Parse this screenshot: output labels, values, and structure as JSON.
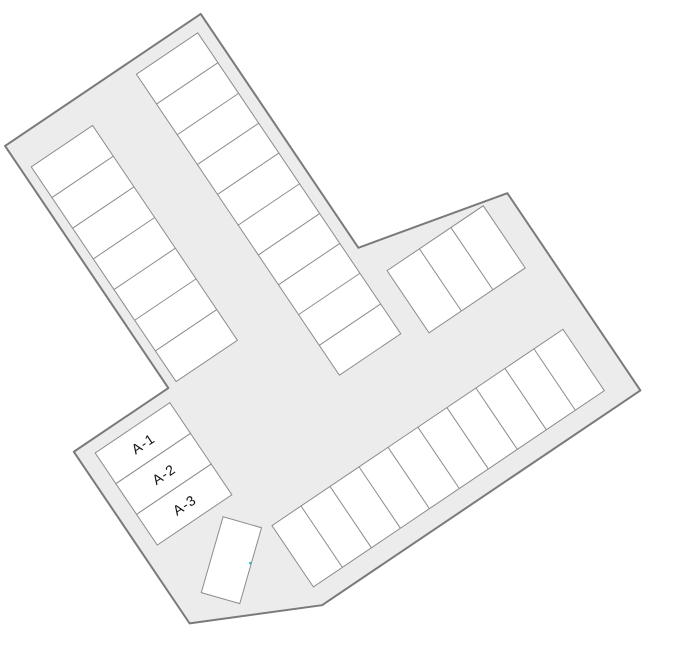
{
  "map": {
    "title": "parking-lot-site-plan",
    "labeled_spaces": [
      {
        "label": "A-1"
      },
      {
        "label": "A-2"
      },
      {
        "label": "A-3"
      }
    ],
    "row_space_counts": {
      "northwest_row": 7,
      "north_center_row": 10,
      "northeast_block": 3,
      "southeast_row": 10,
      "a_block": 3
    },
    "colors": {
      "background": "#ffffff",
      "lot_fill": "#ececec",
      "lot_stroke": "#7a7a7a",
      "space_fill": "#ffffff",
      "space_stroke": "#8c8c8c",
      "label_color": "#111111",
      "marker_teal": "#3dbdbd"
    }
  }
}
